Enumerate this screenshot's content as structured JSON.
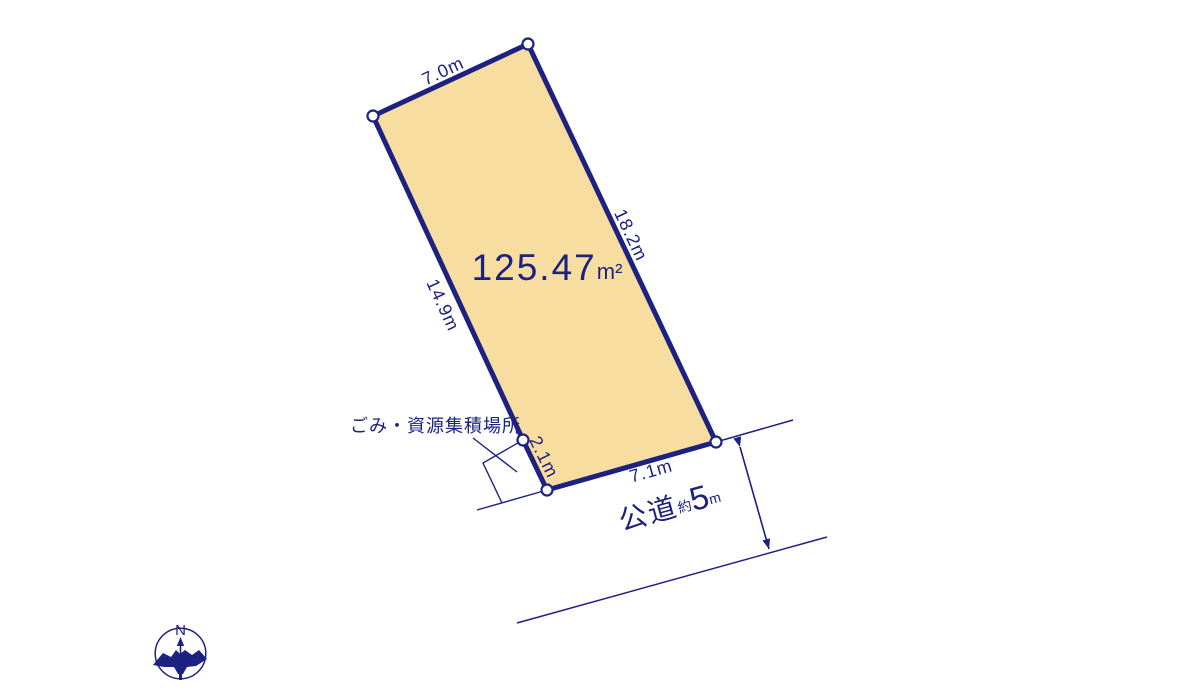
{
  "diagram": {
    "type": "land-plot-survey-drawing",
    "plot": {
      "area": {
        "value": "125.47",
        "unit": "m²"
      },
      "edges": {
        "top": "7.0m",
        "right": "18.2m",
        "left": "14.9m",
        "step": "2.1m",
        "bottom": "7.1m"
      }
    },
    "annotations": {
      "garbage_area_label": "ごみ・資源集積場所",
      "road": {
        "name": "公道",
        "approx": "約",
        "value": "5",
        "unit": "m"
      }
    },
    "compass": {
      "north": "N"
    },
    "colors": {
      "plot_fill": "#f8dda0",
      "line": "#1d2180",
      "vertex_fill": "#ffffff",
      "background": "#ffffff"
    }
  }
}
